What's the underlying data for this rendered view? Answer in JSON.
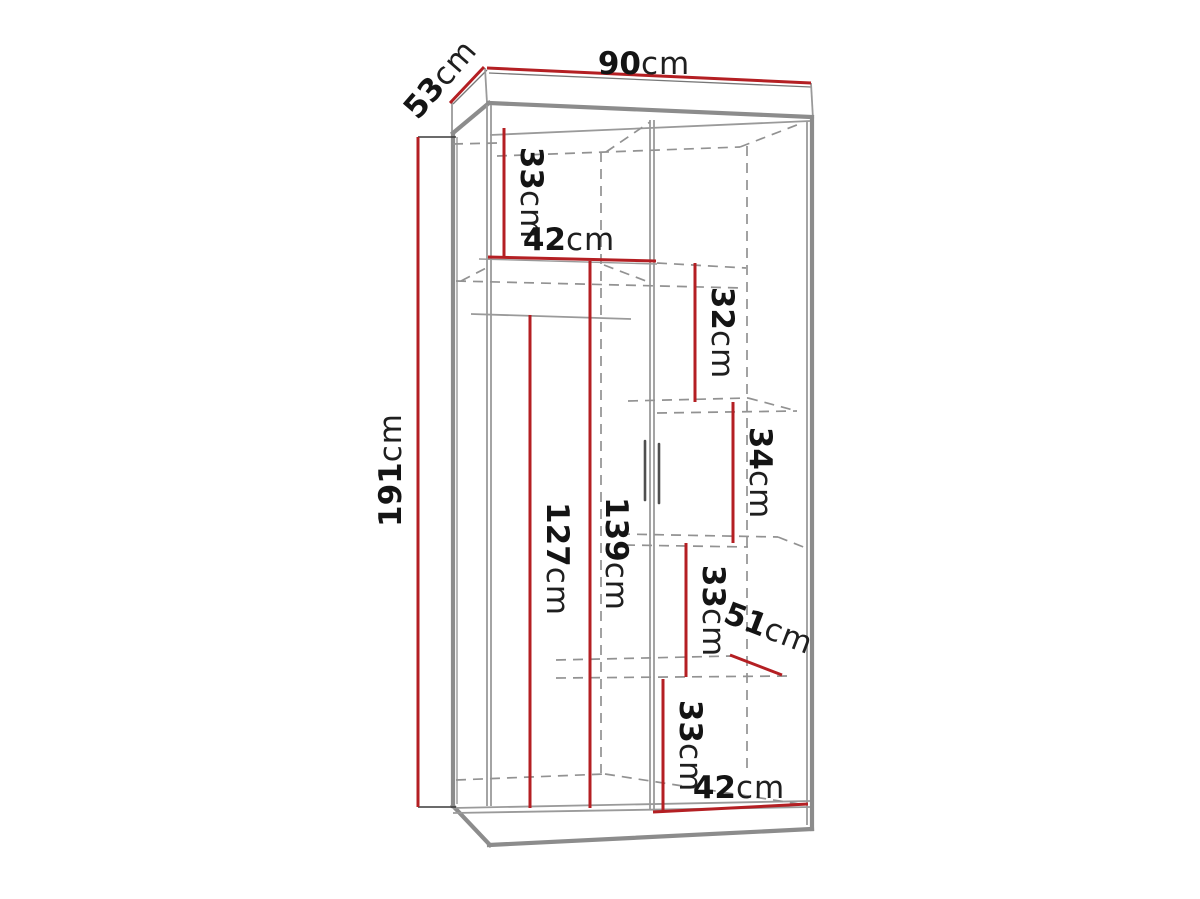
{
  "title": "Wardrobe dimension diagram",
  "units": "cm",
  "dimensions": {
    "width_top": {
      "value": "90",
      "unit": "cm",
      "label": "top width"
    },
    "depth_top": {
      "value": "53",
      "unit": "cm",
      "label": "top depth"
    },
    "height": {
      "value": "191",
      "unit": "cm",
      "label": "overall height"
    },
    "sec_33_top": {
      "value": "33",
      "unit": "cm",
      "label": "top-left section height"
    },
    "shelf_42_top": {
      "value": "42",
      "unit": "cm",
      "label": "top shelf width"
    },
    "sec_32": {
      "value": "32",
      "unit": "cm",
      "label": "right section 1 height"
    },
    "sec_34": {
      "value": "34",
      "unit": "cm",
      "label": "right section 2 height"
    },
    "sec_33_mid": {
      "value": "33",
      "unit": "cm",
      "label": "right section 3 height"
    },
    "depth_51": {
      "value": "51",
      "unit": "cm",
      "label": "shelf depth"
    },
    "sec_33_bottom": {
      "value": "33",
      "unit": "cm",
      "label": "right section 4 height"
    },
    "width_42_bottom": {
      "value": "42",
      "unit": "cm",
      "label": "bottom right width"
    },
    "hang_127": {
      "value": "127",
      "unit": "cm",
      "label": "hanging space height"
    },
    "int_139": {
      "value": "139",
      "unit": "cm",
      "label": "left interior height"
    }
  },
  "colors": {
    "dimension": "#b41f23",
    "outline": "#8c8c8c",
    "outline-thin": "#9a9a9a",
    "dashed": "#929292",
    "text": "#141414",
    "background": "#ffffff"
  }
}
